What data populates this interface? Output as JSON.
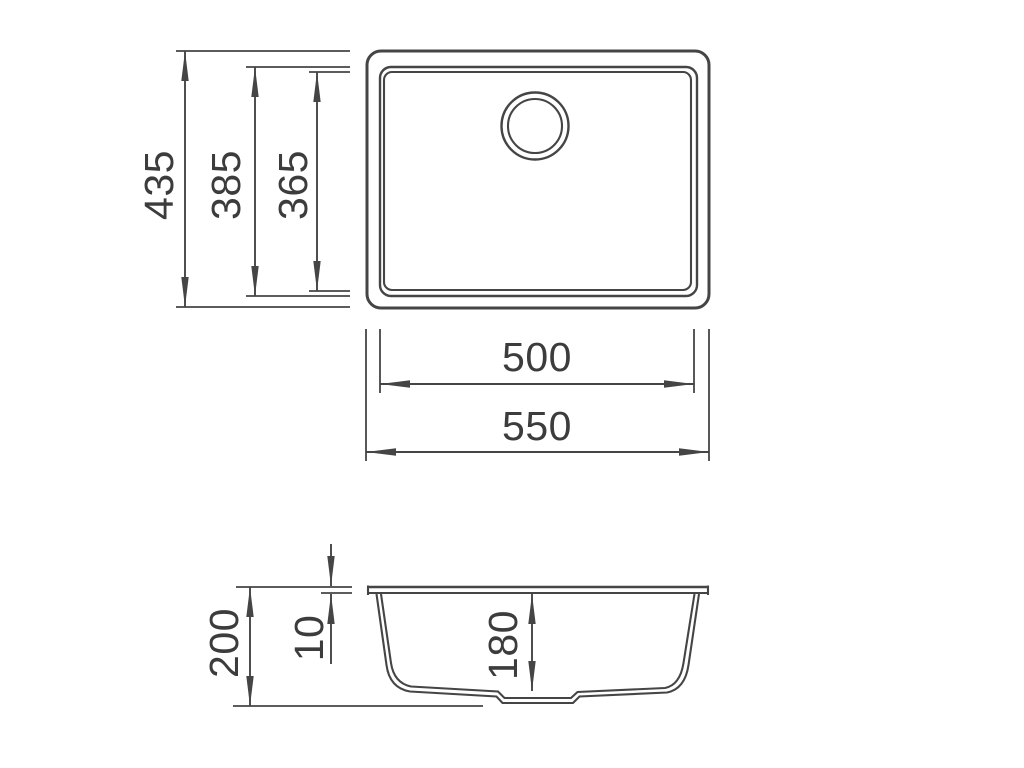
{
  "drawing": {
    "background_color": "#ffffff",
    "line_color": "#454545",
    "text_color": "#3c3c3c",
    "dims": {
      "top_view": {
        "overall_depth": "435",
        "rim_inner_depth": "385",
        "bowl_depth": "365",
        "bowl_width": "500",
        "overall_width": "550"
      },
      "section_view": {
        "overall_height": "200",
        "rim_height": "10",
        "bowl_height": "180"
      }
    }
  }
}
